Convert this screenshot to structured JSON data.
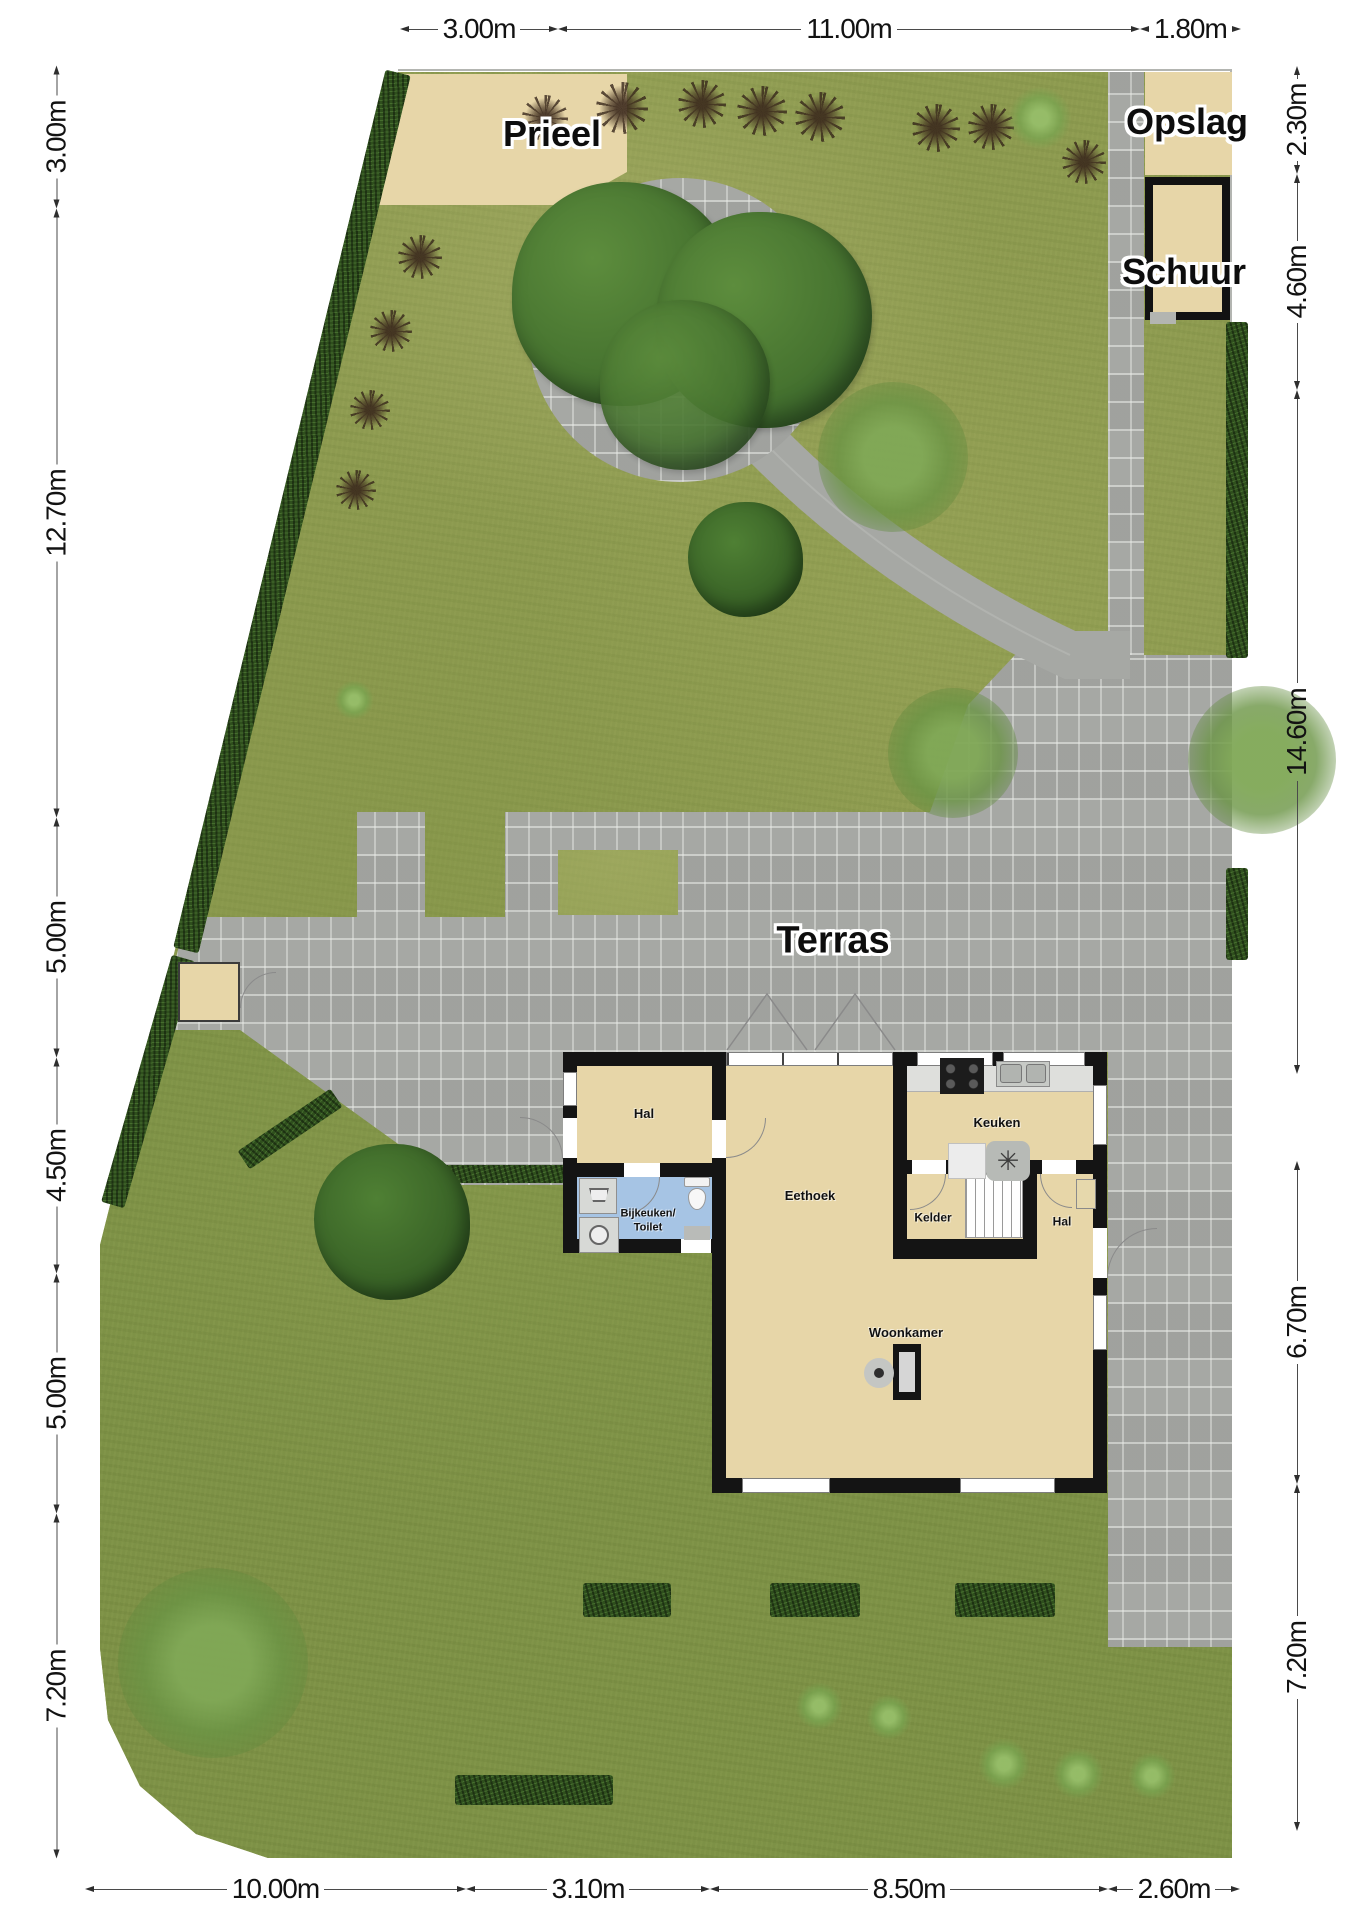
{
  "areas": {
    "prieel": "Prieel",
    "opslag": "Opslag",
    "schuur": "Schuur",
    "terras": "Terras"
  },
  "rooms": {
    "hal_front": "Hal",
    "bijkeuken_toilet": "Bijkeuken/\nToilet",
    "eethoek": "Eethoek",
    "keuken": "Keuken",
    "kelder": "Kelder",
    "hal_back": "Hal",
    "woonkamer": "Woonkamer"
  },
  "dimensions": {
    "top": [
      "3.00m",
      "11.00m",
      "1.80m"
    ],
    "left": [
      "3.00m",
      "12.70m",
      "5.00m",
      "4.50m",
      "5.00m",
      "7.20m"
    ],
    "right_upper": [
      "2.30m",
      "4.60m",
      "14.60m"
    ],
    "right_lower": [
      "6.70m",
      "7.20m"
    ],
    "bottom": [
      "10.00m",
      "3.10m",
      "8.50m",
      "2.60m"
    ]
  },
  "colors": {
    "grass_upper": "#8d9a50",
    "grass_lower": "#7d9146",
    "paver": "#a6a8a4",
    "hedge": "#2f4f1d",
    "beige": "#e7d6a8",
    "room_blue": "#a6c4e4",
    "wall": "#141414"
  }
}
